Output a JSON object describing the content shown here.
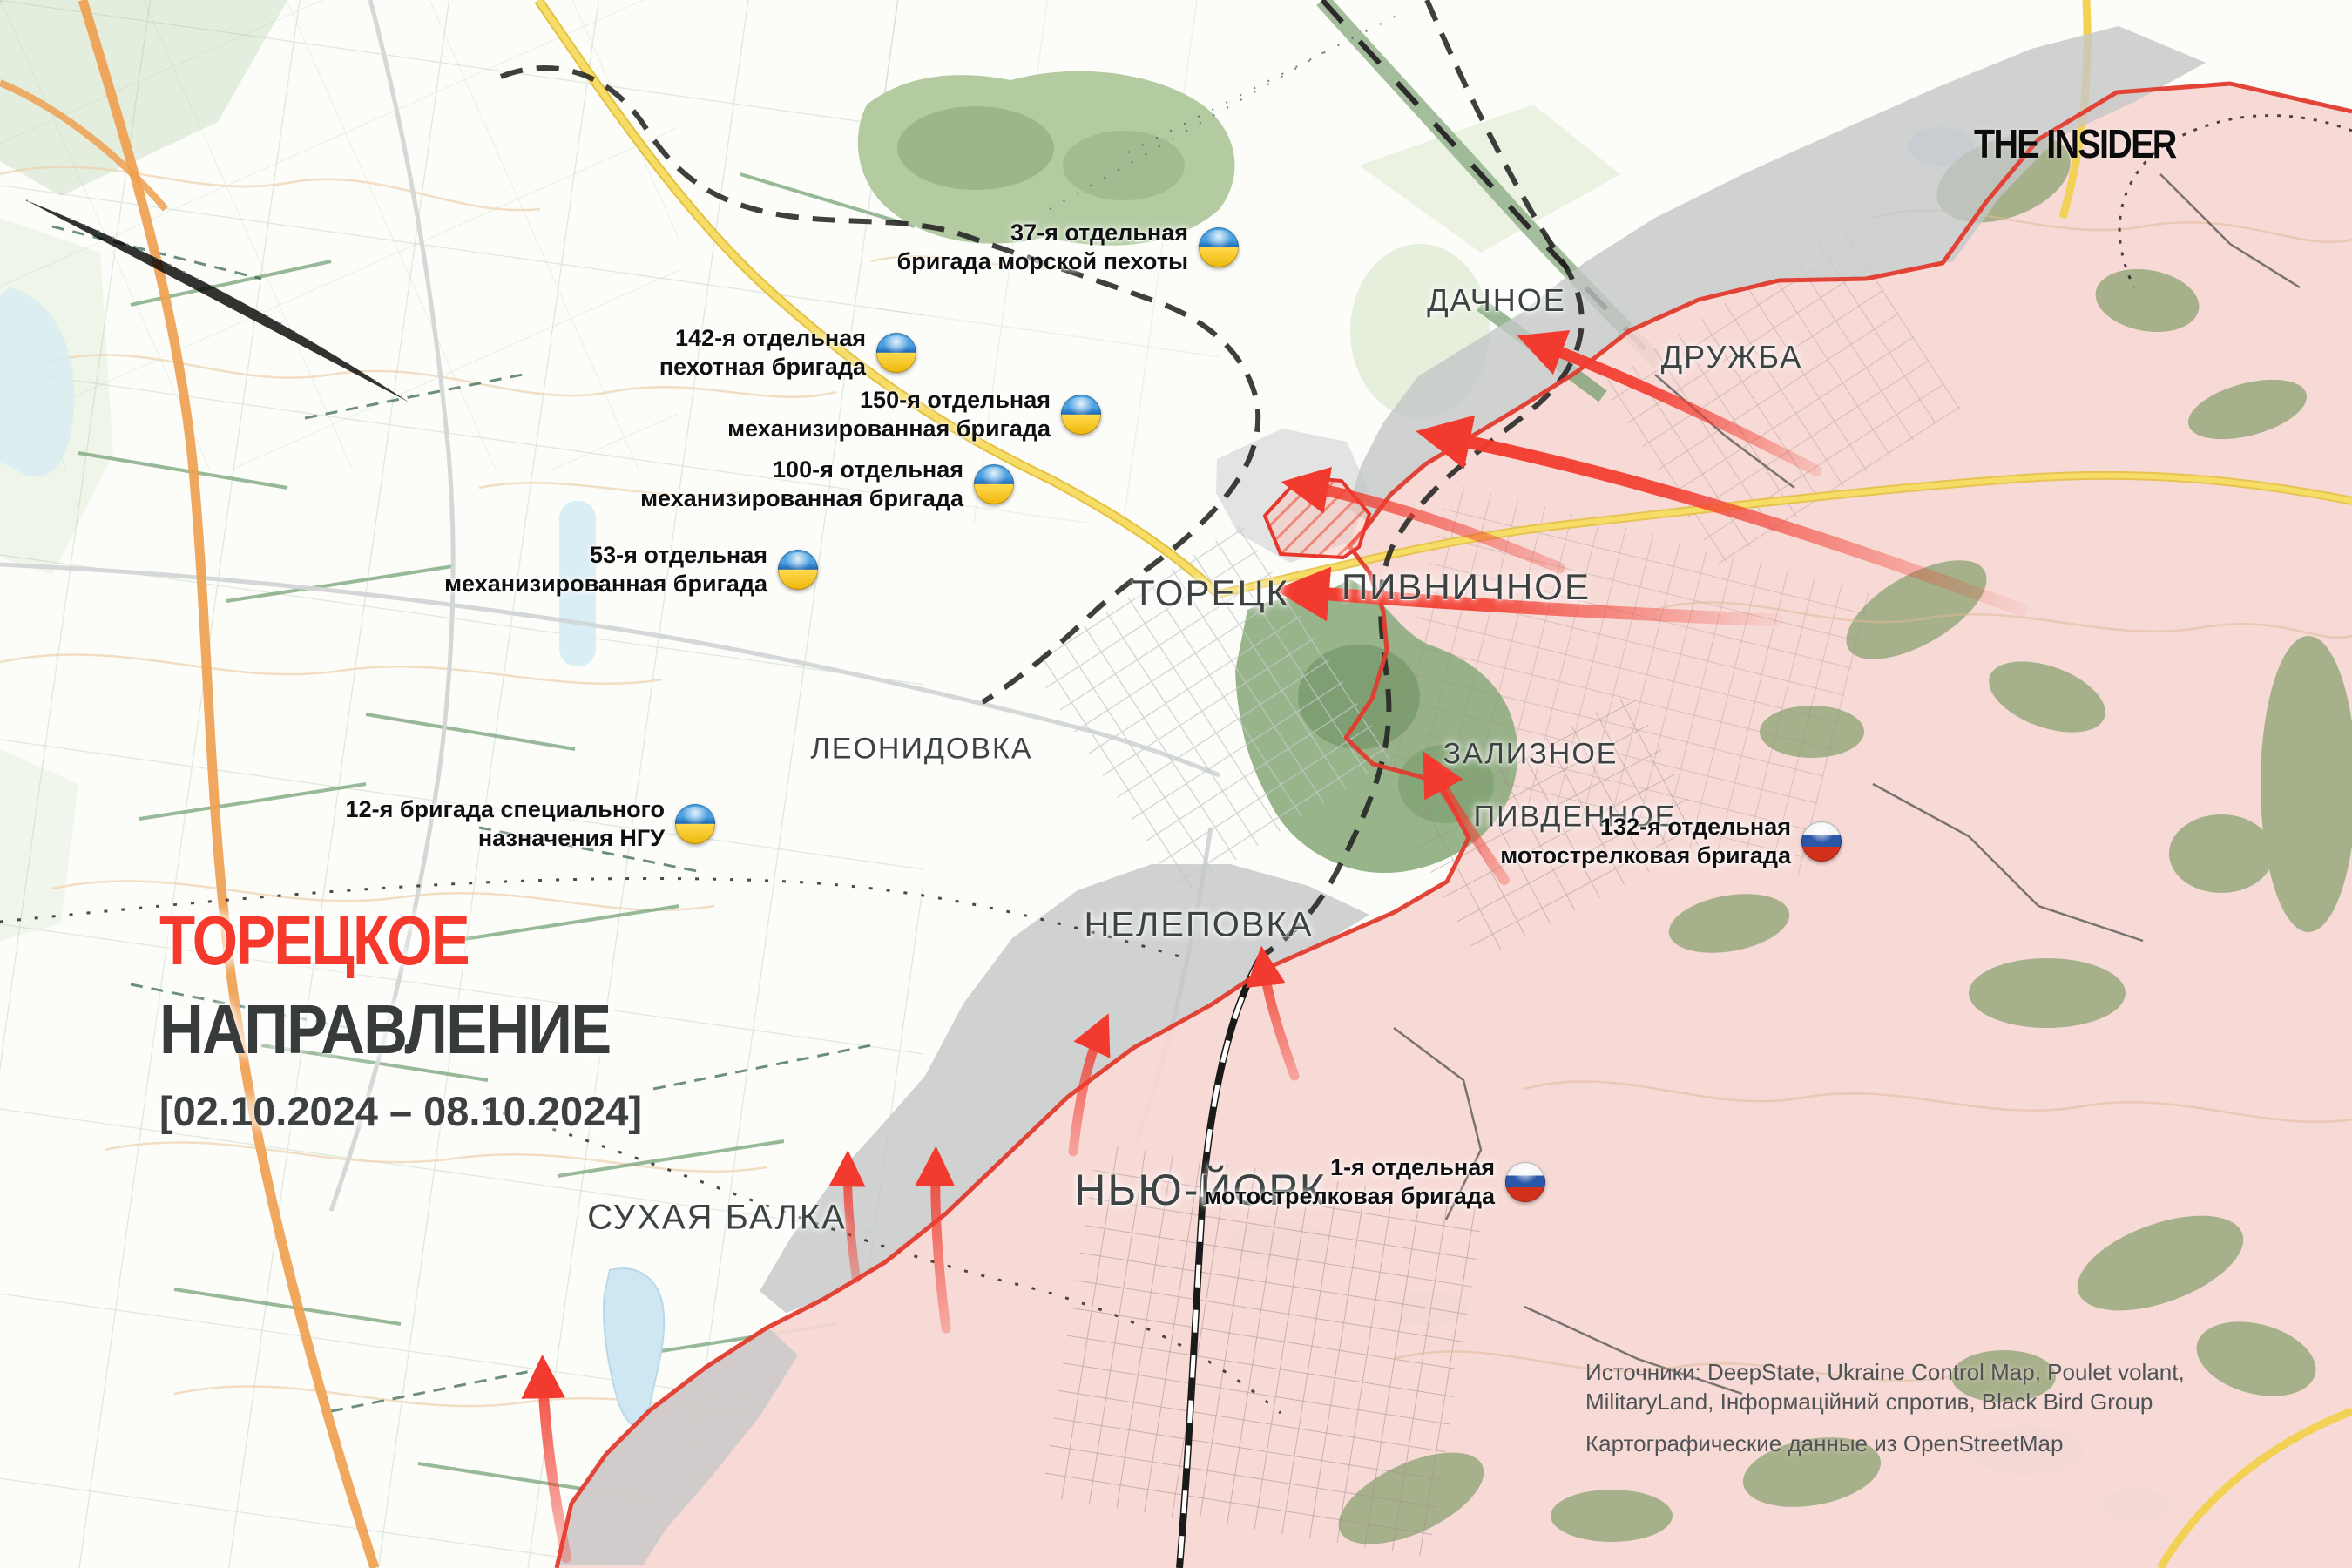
{
  "branding": {
    "logo_text": "THE INSIDER"
  },
  "title": {
    "headline_red": "ТОРЕЦКОЕ",
    "headline_dark": "НАПРАВЛЕНИЕ",
    "date_range": "[02.10.2024 – 08.10.2024]"
  },
  "colors": {
    "title_red": "#f5392c",
    "title_dark": "#373b3b",
    "arrow_red": "#f23b2e",
    "front_line_red": "#e23b2e",
    "occupied_fill": "#f6d7d3",
    "contested_fill": "#c4c7c7",
    "ukraine_flag_blue": "#1d66b8",
    "ukraine_flag_yellow": "#ffd94d",
    "russia_flag_blue": "#2b57a8",
    "russia_flag_red": "#d3301c"
  },
  "places": [
    {
      "name": "ДАЧНОЕ"
    },
    {
      "name": "ДРУЖБА"
    },
    {
      "name": "ТОРЕЦК"
    },
    {
      "name": "ПИВНИЧНОЕ"
    },
    {
      "name": "ЗАЛИЗНОЕ"
    },
    {
      "name": "ПИВДЕННОЕ"
    },
    {
      "name": "ЛЕОНИДОВКА"
    },
    {
      "name": "НЕЛЕПОВКА"
    },
    {
      "name": "НЬЮ-ЙОРК"
    },
    {
      "name": "СУХАЯ БАЛКА"
    }
  ],
  "units": [
    {
      "id": "u37",
      "country": "ua",
      "line1": "37-я отдельная",
      "line2": "бригада морской пехоты"
    },
    {
      "id": "u142",
      "country": "ua",
      "line1": "142-я отдельная",
      "line2": "пехотная бригада"
    },
    {
      "id": "u150",
      "country": "ua",
      "line1": "150-я отдельная",
      "line2": "механизированная бригада"
    },
    {
      "id": "u100",
      "country": "ua",
      "line1": "100-я отдельная",
      "line2": "механизированная бригада"
    },
    {
      "id": "u53",
      "country": "ua",
      "line1": "53-я отдельная",
      "line2": "механизированная бригада"
    },
    {
      "id": "u12",
      "country": "ua",
      "line1": "12-я бригада специального",
      "line2": "назначения НГУ"
    },
    {
      "id": "r132",
      "country": "ru",
      "line1": "132-я отдельная",
      "line2": "мотострелковая бригада"
    },
    {
      "id": "r1",
      "country": "ru",
      "line1": "1-я отдельная",
      "line2": "мотострелковая бригада"
    }
  ],
  "sources": {
    "line1": "Источники: DeepState, Ukraine Control Map, Poulet volant,",
    "line2": "MilitaryLand, Інформаційний спротив, Black Bird Group",
    "line3": "Картографические данные из OpenStreetMap"
  }
}
